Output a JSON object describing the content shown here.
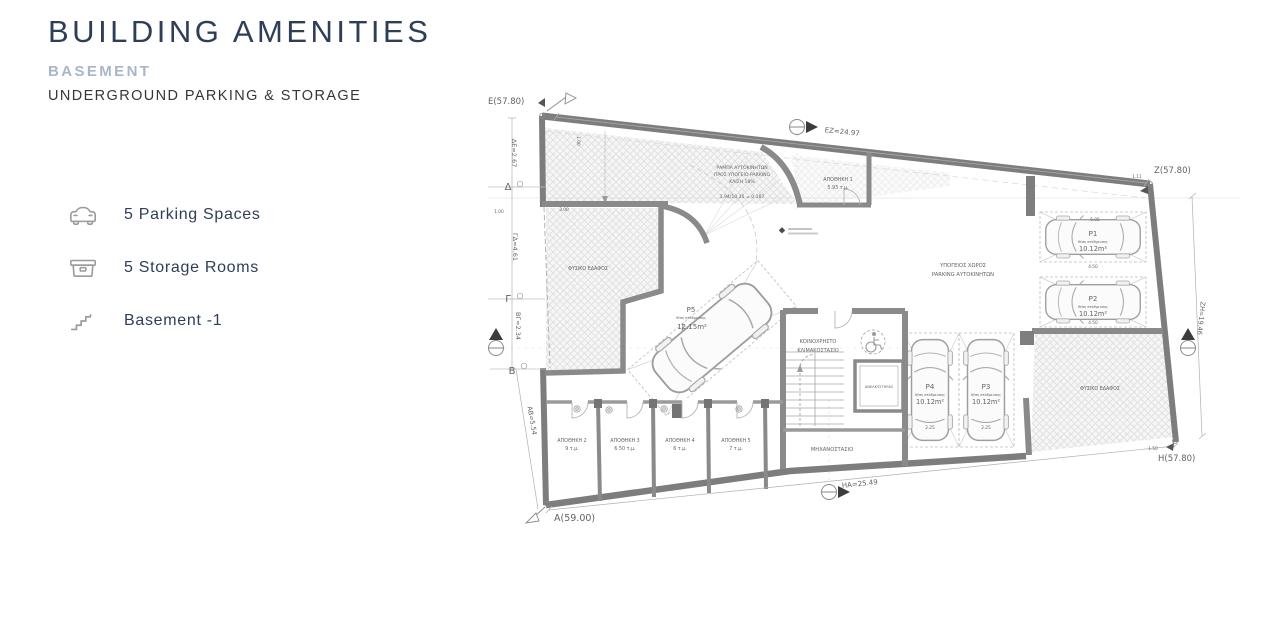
{
  "header": {
    "title": "BUILDING AMENITIES",
    "floor": "BASEMENT",
    "subtitle": "UNDERGROUND PARKING & STORAGE"
  },
  "amenities": [
    {
      "icon": "car-icon",
      "label": "5 Parking Spaces"
    },
    {
      "icon": "storage-box-icon",
      "label": "5 Storage Rooms"
    },
    {
      "icon": "stairs-icon",
      "label": "Basement -1"
    }
  ],
  "plan": {
    "corners": {
      "e": "E(57.80)",
      "z": "Z(57.80)",
      "h": "H(57.80)",
      "a": "A(59.00)"
    },
    "points": {
      "delta": "Δ",
      "gamma": "Γ",
      "beta": "Β"
    },
    "dims": {
      "ez": "ΕΖ=24.97",
      "zh": "ΖΗ=19.46",
      "ha": "ΗΑ=25.49",
      "de": "ΔΕ=2.67",
      "gd": "ΓΔ=4.61",
      "bg": "ΒΓ=2.34",
      "ab": "ΑΒ=5.54"
    },
    "micro": [
      "1.00",
      "3.00",
      "1.00",
      "5.05",
      "4.50",
      "4.50",
      "2.25",
      "2.25",
      "1.11",
      "1.50"
    ],
    "ramp": {
      "l1": "ΡΑΜΠΑ ΑΥΤΟΚΙΝΗΤΩΝ",
      "l2": "ΠΡΟΣ ΥΠΟΓΕΙΟ PARKING",
      "l3": "ΚΛΙΣΗ 18%",
      "l4": "1.94/10.35 = 0.187"
    },
    "labels": {
      "hall1": "ΥΠΟΓΕΙΟΣ ΧΩΡΟΣ",
      "hall2": "PARKING ΑΥΤΟΚΙΝΗΤΩΝ",
      "stair1": "ΚΟΙΝΟΧΡΗΣΤΟ",
      "stair2": "ΚΛΙΜΑΚΟΣΤΑΣΙΟ",
      "elevator": "ΑΝΕΛΚΥΣΤΗΡΑΣ",
      "machine": "ΜΗΧΑΝΟΣΤΑΣΙΟ",
      "ground_left": "ΦΥΣΙΚΟ ΕΔΑΦΟΣ",
      "ground_right": "ΦΥΣΙΚΟ ΕΔΑΦΟΣ"
    },
    "parking": [
      {
        "id": "P1",
        "sub": "θέση στάθμευσης",
        "area": "10.12m²"
      },
      {
        "id": "P2",
        "sub": "θέση στάθμευσης",
        "area": "10.12m²"
      },
      {
        "id": "P3",
        "sub": "θέση στάθμευσης",
        "area": "10.12m²"
      },
      {
        "id": "P4",
        "sub": "θέση στάθμευσης",
        "area": "10.12m²"
      },
      {
        "id": "P5",
        "sub": "θέση στάθμευσης",
        "area": "12.15m²"
      }
    ],
    "storage": [
      {
        "name": "ΑΠΟΘΗΚΗ 1",
        "area": "5.93 τ.μ."
      },
      {
        "name": "ΑΠΟΘΗΚΗ 2",
        "area": "9 τ.μ."
      },
      {
        "name": "ΑΠΟΘΗΚΗ 3",
        "area": "6.50 τ.μ."
      },
      {
        "name": "ΑΠΟΘΗΚΗ 4",
        "area": "6 τ.μ."
      },
      {
        "name": "ΑΠΟΘΗΚΗ 5",
        "area": "7 τ.μ."
      }
    ]
  }
}
